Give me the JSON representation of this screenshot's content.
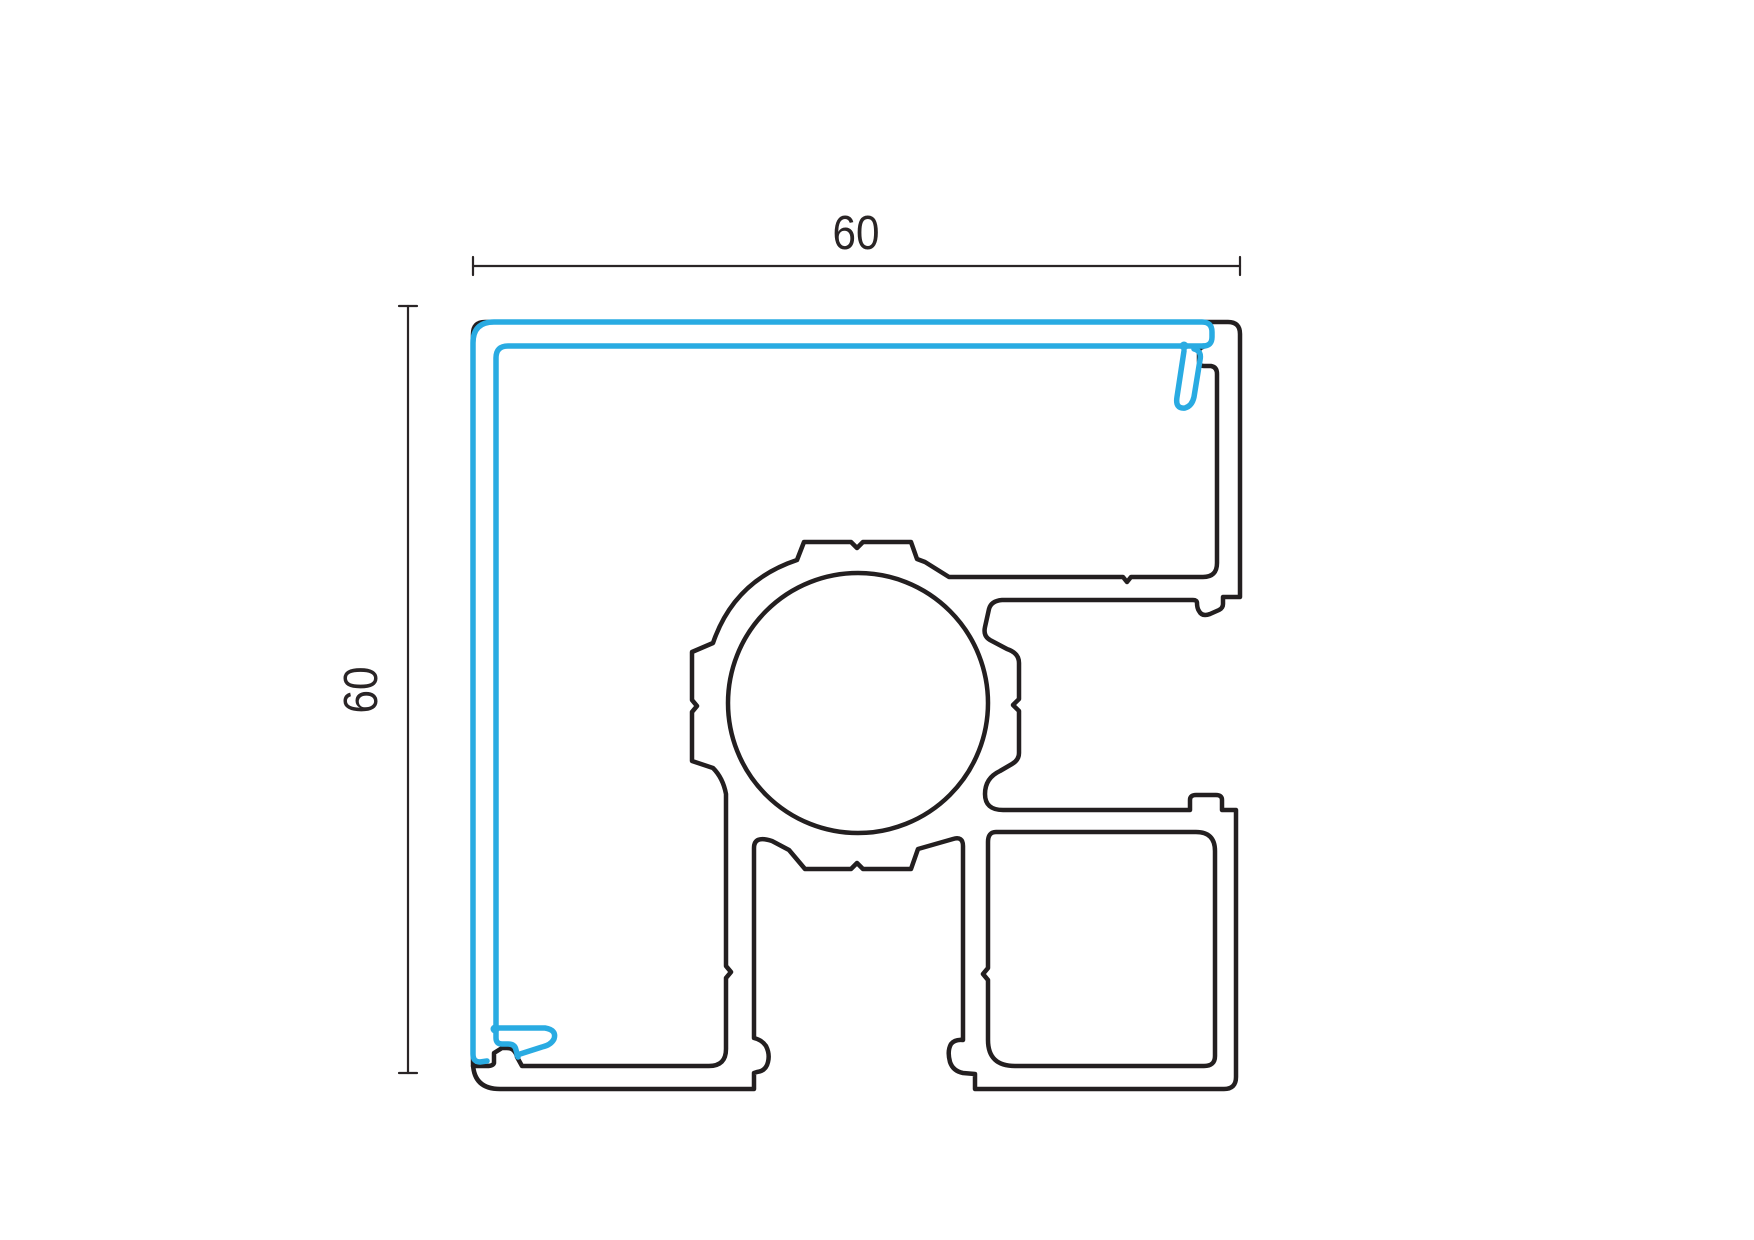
{
  "drawing": {
    "dimensions": {
      "width_label": "60",
      "height_label": "60"
    },
    "colors": {
      "profile_outline": "#231F20",
      "gasket": "#29ABE2",
      "dimension": "#2A2526",
      "background": "#FFFFFF"
    }
  }
}
